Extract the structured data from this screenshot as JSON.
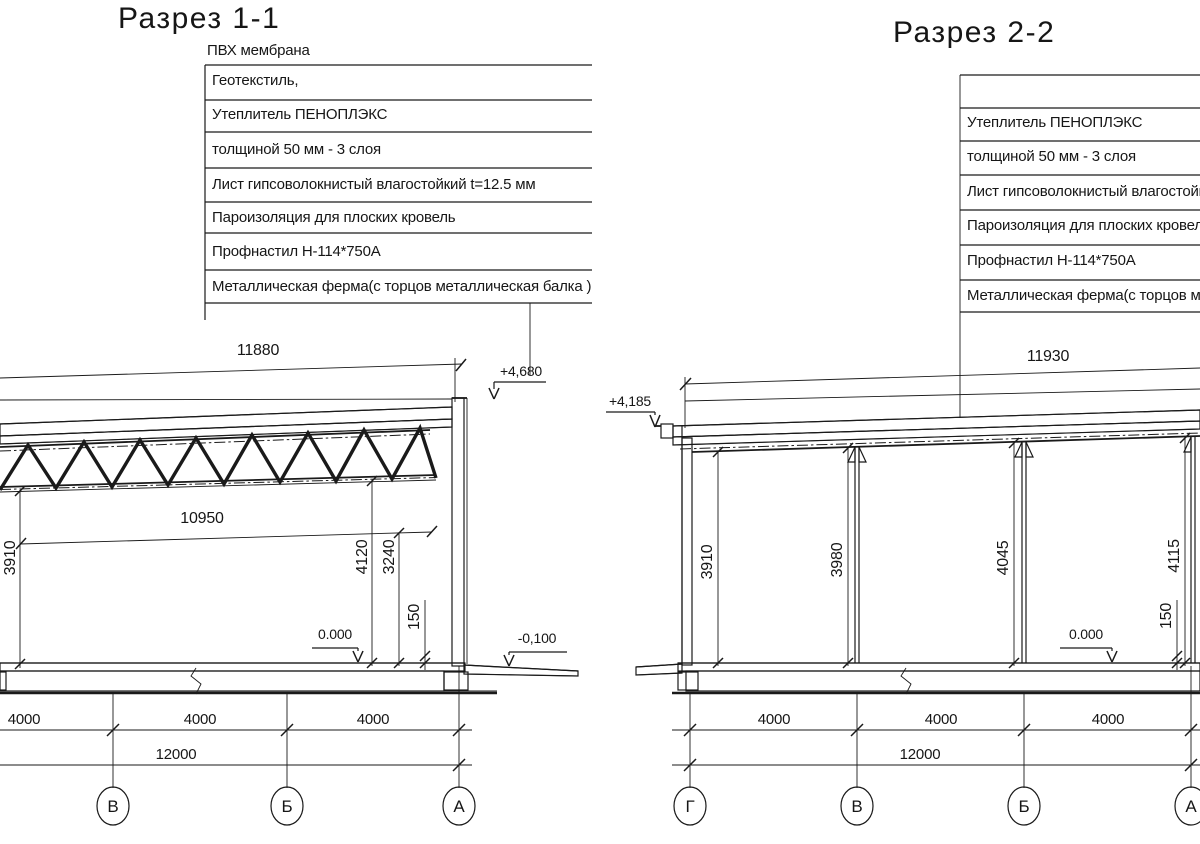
{
  "left": {
    "title": "Разрез 1-1",
    "callout_top": "ПВХ мембрана",
    "callout_rows": [
      "Геотекстиль,",
      "Утеплитель ПЕНОПЛЭКС",
      "толщиной 50 мм - 3 слоя",
      "Лист гипсоволокнистый влагостойкий t=12.5 мм",
      "Пароизоляция для плоских кровель",
      "Профнастил Н-114*750А",
      "Металлическая ферма(с торцов металлическая балка )"
    ],
    "dim_span": "11880",
    "dim_clear": "10950",
    "dim_h_left": "3910",
    "dim_h_right": "4120",
    "dim_h_mid": "3240",
    "dim_slab": "150",
    "lvl_roof": "+4,680",
    "lvl_floor": "0.000",
    "lvl_apron": "-0,100",
    "dims_4000": [
      "4000",
      "4000",
      "4000"
    ],
    "dim_total": "12000",
    "axes": [
      "В",
      "Б",
      "А"
    ]
  },
  "right": {
    "title": "Разрез 2-2",
    "callout_rows": [
      "",
      "Утеплитель ПЕНОПЛЭКС",
      "толщиной 50 мм - 3 слоя",
      "Лист гипсоволокнистый влагостойкий t=12.5 мм",
      "Пароизоляция для плоских кровель",
      "Профнастил Н-114*750А",
      "Металлическая ферма(с торцов металлическая балка )"
    ],
    "dim_span": "11930",
    "dim_h1": "3910",
    "dim_h2": "3980",
    "dim_h3": "4045",
    "dim_h4": "4115",
    "dim_slab": "150",
    "lvl_roof": "+4,185",
    "lvl_floor": "0.000",
    "dims_4000": [
      "4000",
      "4000",
      "4000"
    ],
    "dim_total": "12000",
    "axes": [
      "Г",
      "В",
      "Б",
      "А"
    ]
  }
}
